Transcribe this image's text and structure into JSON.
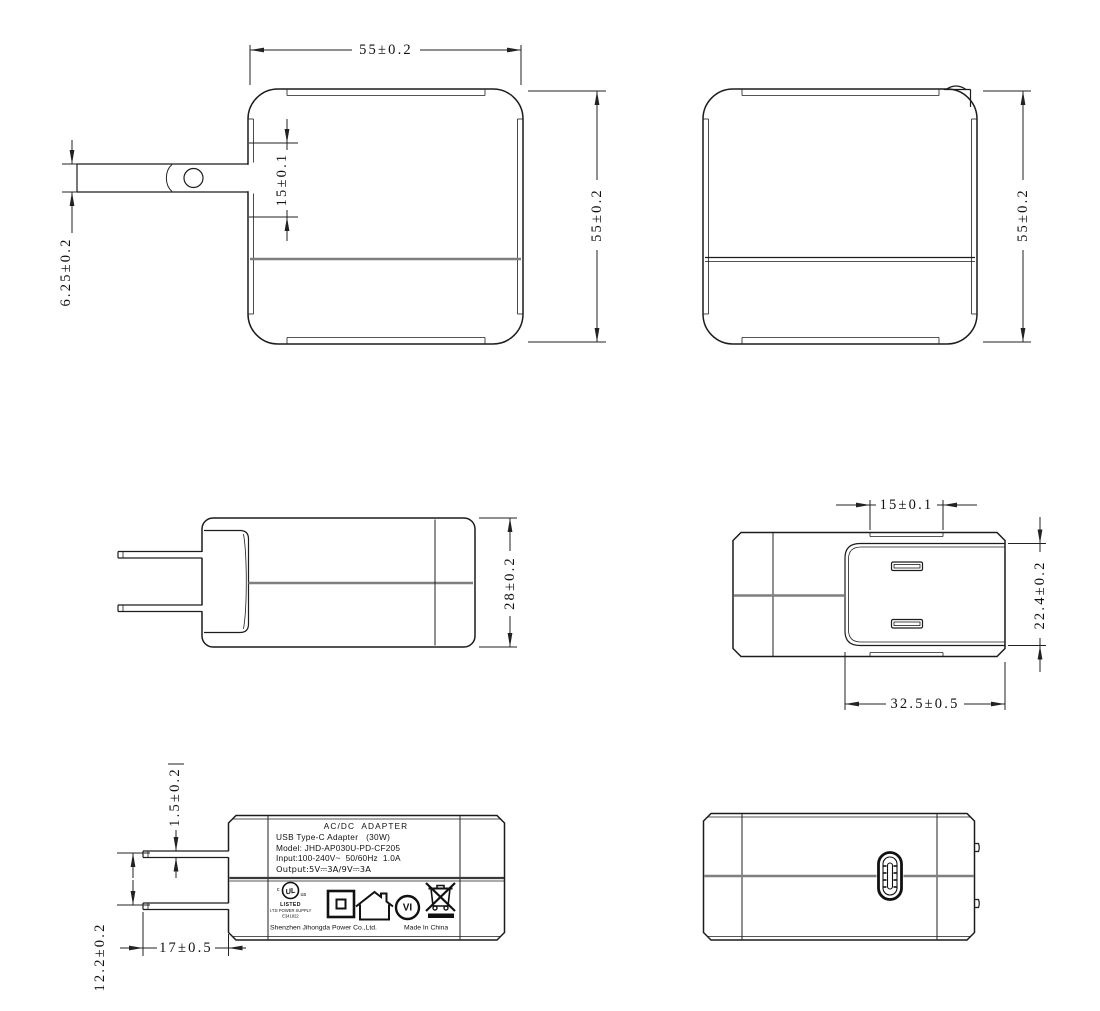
{
  "dims": {
    "front_width": "55±0.2",
    "front_height": "55±0.2",
    "front_pin_span": "15±0.1",
    "front_pin_thickness": "6.25±0.2",
    "back_height": "55±0.2",
    "side_depth": "28±0.2",
    "top_pin_span": "15±0.1",
    "top_recess_height": "22.4±0.2",
    "top_recess_width": "32.5±0.5",
    "label_pin_thickness": "1.5±0.2",
    "label_pin_gap": "12.2±0.2",
    "label_pin_length": "17±0.5"
  },
  "label": {
    "line1": "AC/DC  ADAPTER",
    "line2": "USB Type-C Adapter   (30W)",
    "line3": "Model: JHD-AP030U-PD-CF205",
    "line4": "Input:100-240V~  50/60Hz  1.0A",
    "line5": "Output:5V⎓3A/9V⎓3A",
    "ul_c": "c",
    "ul_mark": "UL",
    "ul_us": "us",
    "listed": "LISTED",
    "ite": "I.T.E POWER SUPPLY",
    "file_no": "E341822",
    "efficiency": "VI",
    "manufacturer": "Shenzhen Jihongda Power Co.,Ltd.",
    "made_in": "Made In China"
  },
  "colors": {
    "line": "#1c1c1c",
    "seam": "#7f7f7f",
    "background": "#ffffff"
  }
}
